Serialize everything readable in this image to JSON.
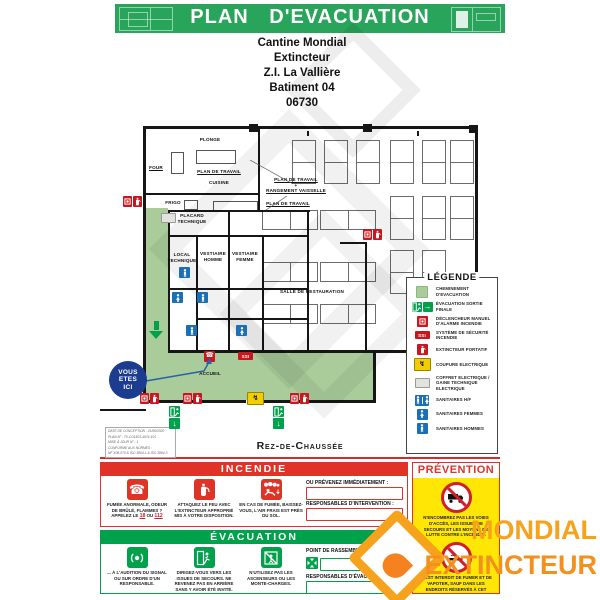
{
  "colors": {
    "band_green": "#29A45B",
    "path_green": "#A9CC9A",
    "icon_red": "#C8171E",
    "panel_red": "#E03227",
    "icon_green": "#00A14B",
    "icon_blue": "#1A6FB5",
    "navy": "#1C3D8F",
    "yellow": "#F2CD00",
    "prevention_bg": "#FFE605",
    "orange": "#F6A21C",
    "orange_dark": "#F4901D",
    "wall": "#161616"
  },
  "header": {
    "title": "PLAN  D'EVACUATION"
  },
  "address": {
    "lines": [
      "Cantine Mondial",
      "Extincteur",
      "Z.I. La Vallière",
      "Batiment 04",
      "06730"
    ]
  },
  "plan": {
    "floor_label": "Rez-de-Chaussée",
    "ssi_label": "SSI",
    "you_are_here": {
      "lines": [
        "VOUS",
        "ETES",
        "ICI"
      ]
    },
    "paths": [
      [
        146,
        208,
        22,
        144
      ],
      [
        146,
        350,
        227,
        50
      ]
    ],
    "walls": [
      [
        143,
        126,
        335,
        3
      ],
      [
        143,
        126,
        3,
        277
      ],
      [
        475,
        126,
        3,
        227
      ],
      [
        168,
        350,
        310,
        3
      ],
      [
        373,
        350,
        3,
        53
      ],
      [
        143,
        400,
        233,
        3
      ],
      [
        100,
        409,
        46,
        2
      ],
      [
        258,
        128,
        2,
        84
      ],
      [
        143,
        193,
        117,
        2
      ],
      [
        168,
        210,
        142,
        2
      ],
      [
        168,
        210,
        2,
        142
      ],
      [
        307,
        210,
        2,
        142
      ],
      [
        168,
        235,
        141,
        2
      ],
      [
        196,
        237,
        2,
        115
      ],
      [
        228,
        212,
        2,
        140
      ],
      [
        262,
        237,
        2,
        115
      ],
      [
        168,
        288,
        140,
        2
      ],
      [
        196,
        318,
        112,
        2
      ],
      [
        340,
        242,
        27,
        2
      ],
      [
        365,
        242,
        2,
        108
      ],
      [
        249,
        124,
        9,
        8
      ],
      [
        363,
        124,
        9,
        8
      ],
      [
        469,
        125,
        9,
        8
      ],
      [
        307,
        131,
        2,
        5
      ],
      [
        417,
        131,
        2,
        5
      ]
    ],
    "wall_gaps": [
      [
        246,
        400,
        16,
        3
      ]
    ],
    "counters": [
      [
        171,
        152,
        13,
        22
      ],
      [
        196,
        150,
        40,
        14
      ],
      [
        184,
        200,
        14,
        10
      ],
      [
        213,
        201,
        45,
        11
      ]
    ],
    "tables_v": [
      [
        292,
        140
      ],
      [
        324,
        140
      ],
      [
        356,
        140
      ],
      [
        390,
        140
      ],
      [
        422,
        140
      ],
      [
        450,
        140
      ],
      [
        390,
        196
      ],
      [
        422,
        196
      ],
      [
        450,
        196
      ],
      [
        390,
        250
      ],
      [
        422,
        250
      ]
    ],
    "tables_h": [
      [
        262,
        210
      ],
      [
        320,
        210
      ],
      [
        262,
        262
      ],
      [
        320,
        262
      ],
      [
        262,
        304
      ],
      [
        320,
        304
      ]
    ],
    "labels": [
      {
        "text": "Plonge",
        "x": 180,
        "y": 137,
        "w": 60
      },
      {
        "text": "Four",
        "x": 144,
        "y": 165,
        "w": 24,
        "u": true
      },
      {
        "text": "Plan de Travail",
        "x": 190,
        "y": 169,
        "w": 58,
        "u": true
      },
      {
        "text": "Cuisine",
        "x": 194,
        "y": 180,
        "w": 50
      },
      {
        "text": "Frigo",
        "x": 163,
        "y": 200,
        "w": 20
      },
      {
        "text": "Placard Technique",
        "x": 172,
        "y": 213,
        "w": 40
      },
      {
        "text": "Plan de Travail",
        "x": 268,
        "y": 177,
        "w": 56,
        "u": true
      },
      {
        "text": "+",
        "x": 268,
        "y": 183,
        "w": 56
      },
      {
        "text": "Rangement Vaisselle",
        "x": 262,
        "y": 188,
        "w": 68,
        "u": true
      },
      {
        "text": "Plan de Travail",
        "x": 260,
        "y": 201,
        "w": 56,
        "u": true
      },
      {
        "text": "Local Technique",
        "x": 167,
        "y": 252,
        "w": 30
      },
      {
        "text": "Vestiaire Homme",
        "x": 197,
        "y": 251,
        "w": 32
      },
      {
        "text": "Vestiaire Femme",
        "x": 229,
        "y": 251,
        "w": 32
      },
      {
        "text": "Salle de Restauration",
        "x": 280,
        "y": 289,
        "w": 64
      },
      {
        "text": "Accueil",
        "x": 192,
        "y": 371,
        "w": 36
      }
    ],
    "icons": [
      {
        "t": "red-pair",
        "x": 123,
        "y": 196
      },
      {
        "t": "red-pair",
        "x": 140,
        "y": 393
      },
      {
        "t": "red-pair",
        "x": 183,
        "y": 393
      },
      {
        "t": "red-pair",
        "x": 290,
        "y": 393
      },
      {
        "t": "red-pair",
        "x": 363,
        "y": 229
      },
      {
        "t": "gte",
        "x": 161,
        "y": 213
      },
      {
        "t": "wc-m",
        "x": 179,
        "y": 267
      },
      {
        "t": "wc-f",
        "x": 172,
        "y": 292
      },
      {
        "t": "wc-m",
        "x": 197,
        "y": 292
      },
      {
        "t": "wc-m",
        "x": 186,
        "y": 325
      },
      {
        "t": "wc-f",
        "x": 236,
        "y": 325
      },
      {
        "t": "alarm-phone",
        "x": 204,
        "y": 351
      },
      {
        "t": "ssi",
        "x": 238,
        "y": 352
      },
      {
        "t": "coupure",
        "x": 247,
        "y": 392
      },
      {
        "t": "exit-final",
        "x": 169,
        "y": 406
      },
      {
        "t": "exit-final",
        "x": 273,
        "y": 406
      },
      {
        "t": "arrow-down",
        "x": 149,
        "y": 321
      }
    ],
    "lines": [
      {
        "x1": 250,
        "y1": 160,
        "x2": 293,
        "y2": 184,
        "c": "#555",
        "w": 0.7
      },
      {
        "x1": 287,
        "y1": 196,
        "x2": 266,
        "y2": 210,
        "c": "#555",
        "w": 0.7
      },
      {
        "x1": 146,
        "y1": 381,
        "x2": 204,
        "y2": 371,
        "c": "#2B5FA8",
        "w": 1.4
      },
      {
        "x1": 204,
        "y1": 371,
        "x2": 209,
        "y2": 362,
        "c": "#2B5FA8",
        "w": 1.4
      }
    ]
  },
  "doc_info": {
    "lines": [
      "DATE DE CONCEPTION : 21/08/2020",
      "PLAN N° : 70-CO1503-4974-101",
      "MISE À JOUR N° : 1",
      "CONFORME AUX NORMES :",
      "NF X08-070 & ISO 3864-1 & ISO 3864-3"
    ]
  },
  "legend": {
    "title": "LÉGENDE",
    "items": [
      {
        "icon": "chem",
        "label": "CHEMINEMENT D'EVACUATION"
      },
      {
        "icon": "exit-final-h",
        "label": "ÉVACUATION SORTIE FINALE"
      },
      {
        "icon": "dm",
        "label": "DÉCLENCHEUR MANUEL D'ALARME INCENDIE"
      },
      {
        "icon": "ssi",
        "label": "SYSTÈME DE SÉCURITÉ INCENDIE"
      },
      {
        "icon": "ext",
        "label": "EXTINCTEUR PORTATIF"
      },
      {
        "icon": "coupure",
        "label": "COUPURE ELECTRIQUE"
      },
      {
        "icon": "gte",
        "label": "COFFRET ELECTRIQUE / GAINE TECHNIQUE ELECTRIQUE"
      },
      {
        "icon": "wc-hf",
        "label": "SANITAIRES H/F"
      },
      {
        "icon": "wc-f",
        "label": "SANITAIRES FEMMES"
      },
      {
        "icon": "wc-m",
        "label": "SANITAIRES HOMMES"
      }
    ]
  },
  "panels": {
    "incendie": {
      "title": "INCENDIE",
      "cols": [
        {
          "icon": "phone-flame",
          "caption": "FUMÉE ANORMALE, ODEUR DE BRÛLÉ, FLAMMES ?",
          "call": {
            "pre": "APPELEZ LE",
            "n1": "18",
            "mid": "OU",
            "n2": "112"
          }
        },
        {
          "icon": "extinguisher",
          "caption": "ATTAQUEZ LE FEU AVEC L'EXTINCTEUR APPROPRIÉ MIS À VOTRE DISPOSITION."
        },
        {
          "icon": "crawl-low",
          "caption": "EN CAS DE FUMÉE, BAISSEZ-VOUS, L'AIR FRAIS EST PRÈS DU SOL."
        }
      ],
      "right": [
        {
          "label": "OU PRÉVENEZ IMMÉDIATEMENT :"
        },
        {
          "label": "RESPONSABLES D'INTERVENTION :"
        }
      ]
    },
    "evacuation": {
      "title": "ÉVACUATION",
      "cols": [
        {
          "icon": "alarm-signal",
          "caption": "... À L'AUDITION DU SIGNAL OU SUR ORDRE D'UN RESPONSABLE."
        },
        {
          "icon": "exit-run",
          "caption": "DIRIGEZ-VOUS VERS LES ISSUES DE SECOURS. NE REVENEZ PAS EN ARRIÈRE SANS Y AVOIR ÉTÉ INVITÉ."
        },
        {
          "icon": "no-elevator",
          "caption": "N'UTILISEZ PAS LES ASCENSEURS OU LES MONTE-CHARGES."
        }
      ],
      "right": [
        {
          "label": "POINT DE RASSEMBLEMENT :",
          "icon": "assembly-point"
        },
        {
          "label": "RESPONSABLES D'ÉVACUATION :"
        }
      ]
    },
    "prevention": {
      "title": "PRÉVENTION",
      "items": [
        {
          "icon": "no-vehicles",
          "text": "N'ENCOMBREZ PAS LES VOIES D'ACCÈS, LES ISSUES DE SECOURS ET LES MOYENS DE LUTTE CONTRE L'INCENDIE."
        },
        {
          "icon": "no-smoking",
          "text": "IL EST INTERDIT DE FUMER ET DE VAPOTER, SAUF DANS LES ENDROITS RÉSERVÉS À CET EFFET."
        }
      ]
    }
  },
  "brand": {
    "line1": "MONDIAL",
    "line2": "EXTINCTEUR"
  }
}
